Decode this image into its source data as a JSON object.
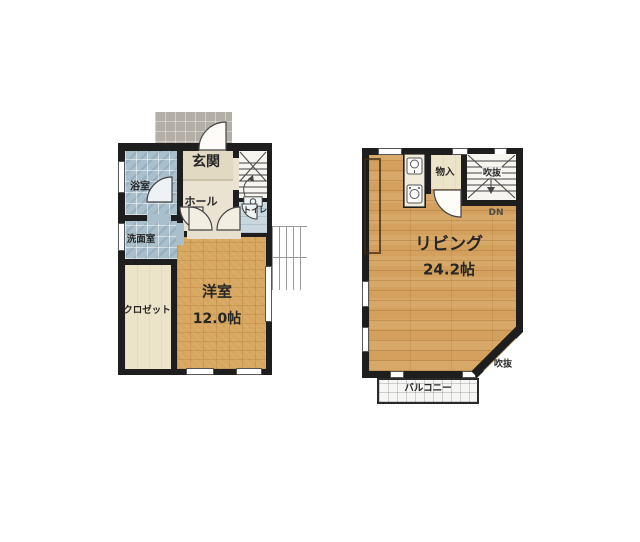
{
  "floor1": {
    "genkan": "玄関",
    "bath": "浴室",
    "hall": "ホール",
    "toilet": "トイレ",
    "washroom": "洗面室",
    "closet": "クロゼット",
    "bedroom": "洋室",
    "bedroom_size": "12.0帖"
  },
  "floor2": {
    "storage": "物入",
    "stair_void": "吹抜",
    "down": "DN",
    "living": "リビング",
    "living_size": "24.2帖",
    "corner_void": "吹抜",
    "balcony": "バルコニー"
  },
  "colors": {
    "wall": "#1e1e1e",
    "wood_floor_1f": "#d7a65f",
    "wood_floor_2f": "#d3a15d",
    "wet_area_tile": "#a9bfcc",
    "entrance_beige": "#ebe3d2",
    "closet_cream": "#ece4c9",
    "porch_gray": "#b3afa7"
  }
}
